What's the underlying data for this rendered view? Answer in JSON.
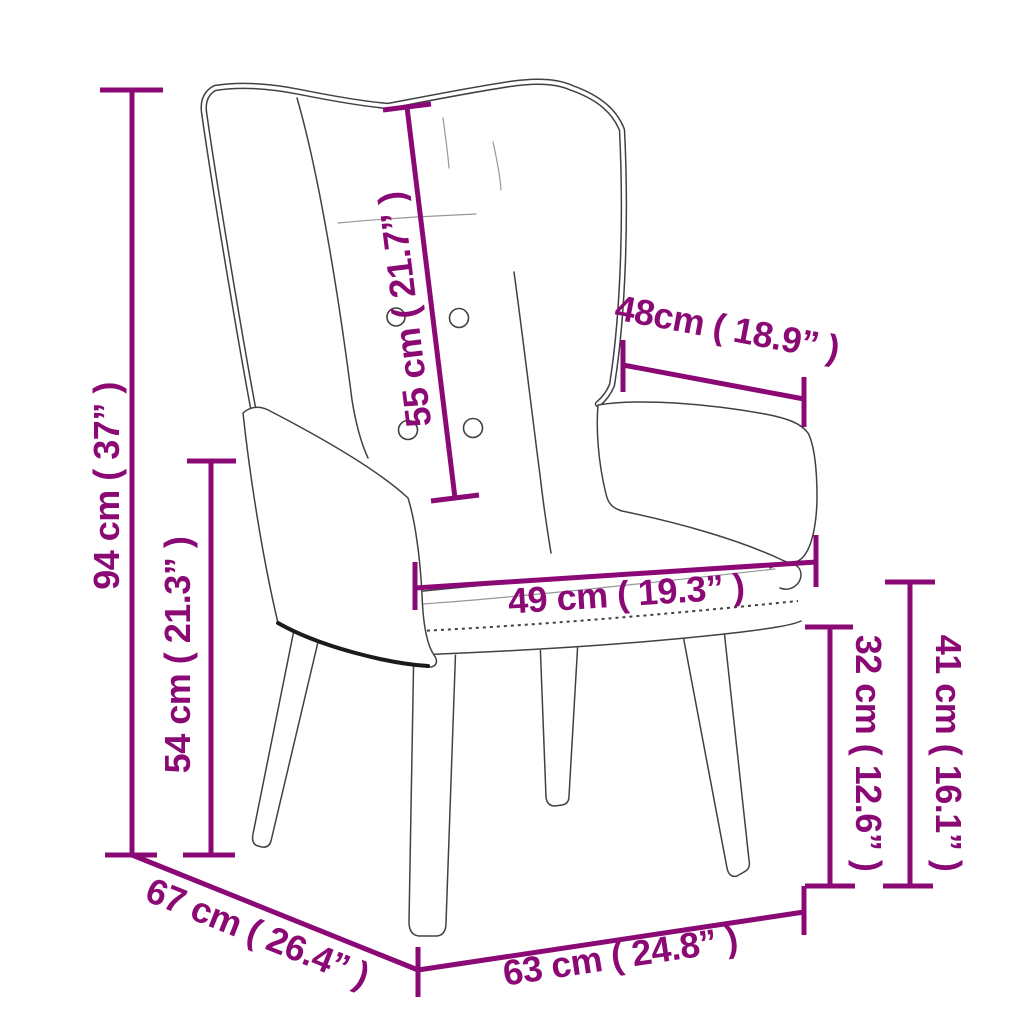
{
  "page": {
    "title": "Wingback relax chair dimension diagram"
  },
  "colors": {
    "dimension": "#8b0974",
    "chairline": "#414141",
    "background": "#ffffff"
  },
  "chair": {
    "description": "Line drawing of a wingback relax chair with tufted backrest, two armrests, seat cushion and four splayed legs"
  },
  "dimensions": [
    {
      "id": "total-height",
      "label": "94 cm ( 37” )",
      "cm": 94,
      "inches": 37
    },
    {
      "id": "armrest-height",
      "label": "54 cm ( 21.3” )",
      "cm": 54,
      "inches": 21.3
    },
    {
      "id": "backrest-length",
      "label": "55 cm ( 21.7” )",
      "cm": 55,
      "inches": 21.7
    },
    {
      "id": "armrest-length",
      "label": "48cm ( 18.9” )",
      "cm": 48,
      "inches": 18.9
    },
    {
      "id": "seat-width",
      "label": "49 cm ( 19.3” )",
      "cm": 49,
      "inches": 19.3
    },
    {
      "id": "leg-height",
      "label": "32 cm ( 12.6” )",
      "cm": 32,
      "inches": 12.6
    },
    {
      "id": "seat-height",
      "label": "41 cm ( 16.1” )",
      "cm": 41,
      "inches": 16.1
    },
    {
      "id": "depth",
      "label": "67 cm ( 26.4” )",
      "cm": 67,
      "inches": 26.4
    },
    {
      "id": "base-width",
      "label": "63 cm ( 24.8” )",
      "cm": 63,
      "inches": 24.8
    }
  ]
}
